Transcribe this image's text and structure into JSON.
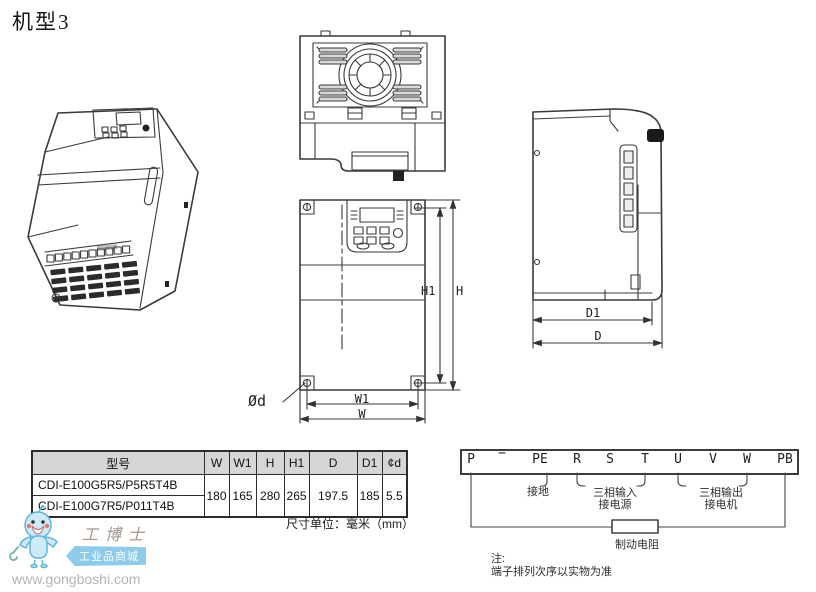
{
  "title": "机型3",
  "front_dims": {
    "h1": "H1",
    "h": "H",
    "w1": "W1",
    "w": "W",
    "hole": "Ød"
  },
  "side_dims": {
    "d1": "D1",
    "d": "D"
  },
  "table": {
    "headers": [
      "型号",
      "W",
      "W1",
      "H",
      "H1",
      "D",
      "D1",
      "¢d"
    ],
    "rows": [
      {
        "model": "CDI-E100G5R5/P5R5T4B"
      },
      {
        "model": "CDI-E100G7R5/P011T4B"
      }
    ],
    "shared_values": {
      "W": "180",
      "W1": "165",
      "H": "280",
      "H1": "265",
      "D": "197.5",
      "D1": "185",
      "d": "5.5"
    },
    "unit_note": "尺寸单位：毫米（mm）"
  },
  "terminal_diagram": {
    "terminals": [
      "P",
      "−",
      "PE",
      "R",
      "S",
      "T",
      "U",
      "V",
      "W",
      "PB"
    ],
    "ground": "接地",
    "input_line1": "三相输入",
    "input_line2": "接电源",
    "output_line1": "三相输出",
    "output_line2": "接电机",
    "brake_resistor": "制动电阻",
    "note_label": "注:",
    "note_text": "端子排列次序以实物为准"
  },
  "watermark": {
    "brand": "工博士",
    "tagline": "工业品商城",
    "url": "www.gongboshi.com"
  },
  "colors": {
    "line": "#3a3a3a",
    "table_header_bg": "#d6d6d6",
    "logo_blue": "#cdeaf6",
    "logo_outline": "#5fb6dc",
    "brand_text": "#a3958a",
    "url_text": "#b5b5b5"
  }
}
